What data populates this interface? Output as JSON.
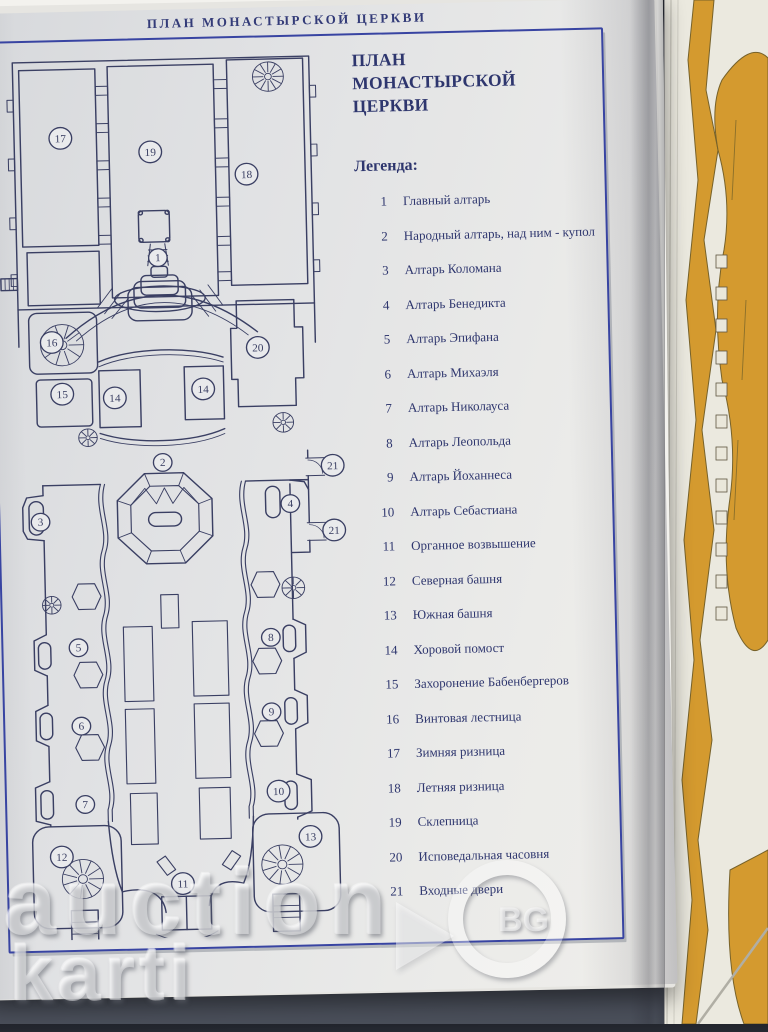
{
  "photo": {
    "watermark": {
      "word1": "auction",
      "badge": "BG",
      "word2": "karti"
    }
  },
  "page": {
    "header": "ПЛАН МОНАСТЫРСКОЙ ЦЕРКВИ",
    "title_line1": "ПЛАН",
    "title_line2": "МОНАСТЫРСКОЙ",
    "title_line3": "ЦЕРКВИ",
    "legend_heading": "Легенда:"
  },
  "legend": {
    "items": [
      {
        "num": "1",
        "label": "Главный алтарь"
      },
      {
        "num": "2",
        "label": "Народный алтарь, над ним - купол"
      },
      {
        "num": "3",
        "label": "Алтарь Коломана"
      },
      {
        "num": "4",
        "label": "Алтарь Бенедикта"
      },
      {
        "num": "5",
        "label": "Алтарь Эпифана"
      },
      {
        "num": "6",
        "label": "Алтарь Михаэля"
      },
      {
        "num": "7",
        "label": "Алтарь Николауса"
      },
      {
        "num": "8",
        "label": "Алтарь Леопольда"
      },
      {
        "num": "9",
        "label": "Алтарь Йоханнеса"
      },
      {
        "num": "10",
        "label": "Алтарь Себастиана"
      },
      {
        "num": "11",
        "label": "Органное возвышение"
      },
      {
        "num": "12",
        "label": "Северная башня"
      },
      {
        "num": "13",
        "label": "Южная башня"
      },
      {
        "num": "14",
        "label": "Хоровой помост"
      },
      {
        "num": "15",
        "label": "Захоронение Бабенбергеров"
      },
      {
        "num": "16",
        "label": "Винтовая лестница"
      },
      {
        "num": "17",
        "label": "Зимняя ризница"
      },
      {
        "num": "18",
        "label": "Летняя ризница"
      },
      {
        "num": "19",
        "label": "Склепница"
      },
      {
        "num": "20",
        "label": "Исповедальная часовня"
      },
      {
        "num": "21",
        "label": "Входные двери"
      }
    ]
  },
  "plan": {
    "markers": [
      {
        "num": "17",
        "x": 65,
        "y": 92,
        "r": 11
      },
      {
        "num": "19",
        "x": 152,
        "y": 108,
        "r": 11
      },
      {
        "num": "18",
        "x": 245,
        "y": 133,
        "r": 11
      },
      {
        "num": "1",
        "x": 157,
        "y": 216,
        "r": 9
      },
      {
        "num": "16",
        "x": 52,
        "y": 300,
        "r": 11
      },
      {
        "num": "20",
        "x": 252,
        "y": 310,
        "r": 11
      },
      {
        "num": "15",
        "x": 61,
        "y": 353,
        "r": 11
      },
      {
        "num": "14",
        "x": 112,
        "y": 358,
        "r": 11
      },
      {
        "num": "14",
        "x": 198,
        "y": 351,
        "r": 11
      },
      {
        "num": "2",
        "x": 157,
        "y": 425,
        "r": 9
      },
      {
        "num": "21",
        "x": 322,
        "y": 432,
        "r": 11
      },
      {
        "num": "3",
        "x": 37,
        "y": 483,
        "r": 9
      },
      {
        "num": "4",
        "x": 280,
        "y": 470,
        "r": 9
      },
      {
        "num": "21",
        "x": 322,
        "y": 498,
        "r": 11
      },
      {
        "num": "5",
        "x": 71,
        "y": 612,
        "r": 9
      },
      {
        "num": "8",
        "x": 258,
        "y": 606,
        "r": 9
      },
      {
        "num": "6",
        "x": 72,
        "y": 692,
        "r": 9
      },
      {
        "num": "9",
        "x": 257,
        "y": 682,
        "r": 9
      },
      {
        "num": "7",
        "x": 74,
        "y": 772,
        "r": 9
      },
      {
        "num": "10",
        "x": 262,
        "y": 763,
        "r": 11
      },
      {
        "num": "12",
        "x": 50,
        "y": 825,
        "r": 11
      },
      {
        "num": "13",
        "x": 292,
        "y": 810,
        "r": 11
      },
      {
        "num": "11",
        "x": 167,
        "y": 855,
        "r": 11
      }
    ]
  },
  "colors": {
    "ink": "#3a3f63",
    "frame_blue": "#3844a2",
    "text_navy": "#2e366e",
    "header_blue": "#333b78",
    "gold": "#d49a2f",
    "gold_outline": "#77622a",
    "background": "#3b404b"
  }
}
